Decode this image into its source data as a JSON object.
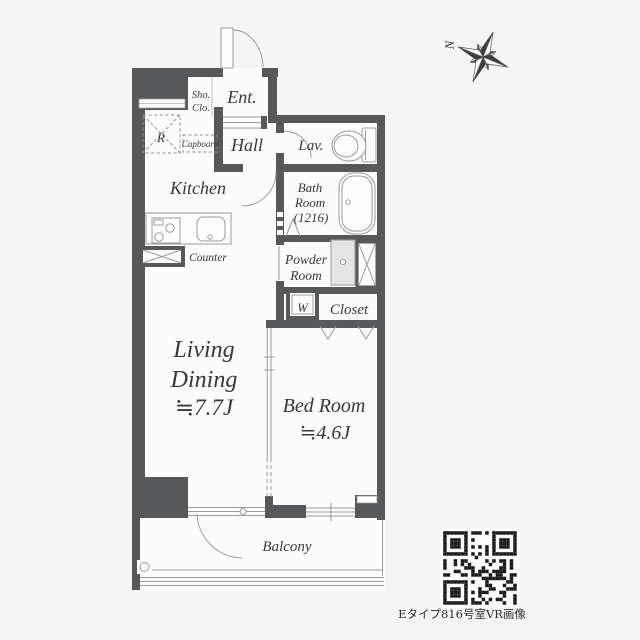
{
  "compass": {
    "north_label": "N"
  },
  "labels": {
    "sho_clo_1": "Sho.",
    "sho_clo_2": "Clo.",
    "ent": "Ent.",
    "hall": "Hall",
    "lav": "Lav.",
    "kitchen": "Kitchen",
    "refrigerator": "R",
    "cupboard": "Cupboard",
    "counter": "Counter",
    "bath_1": "Bath",
    "bath_2": "Room",
    "bath_3": "(1216)",
    "powder_1": "Powder",
    "powder_2": "Room",
    "washer": "W",
    "closet": "Closet",
    "living_1": "Living",
    "living_2": "Dining",
    "living_3": "≒7.7J",
    "bedroom_1": "Bed Room",
    "bedroom_2": "≒4.6J",
    "balcony": "Balcony"
  },
  "qr_caption": "Eタイプ816号室VR画像",
  "colors": {
    "background": "#f5f5f6",
    "wall": "#57585a",
    "room": "#fcfcfd",
    "fixture_line": "#9a9b9c",
    "text": "#37383a",
    "qr": "#1b1b1c"
  }
}
